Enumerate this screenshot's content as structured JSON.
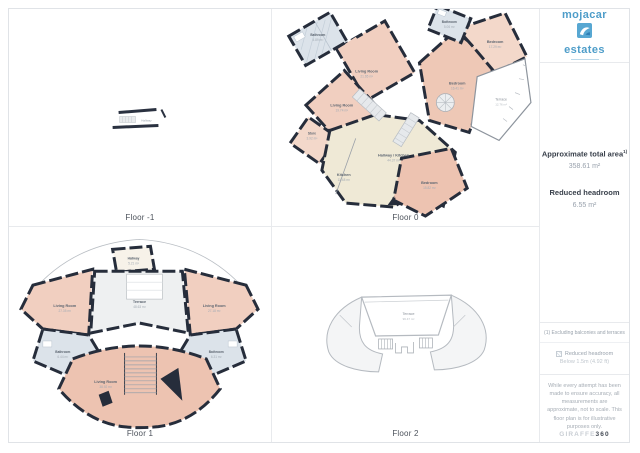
{
  "brand": {
    "word_top": "mojacar",
    "word_bottom": "estates",
    "color": "#4e9dc9"
  },
  "sidebar": {
    "total_area": {
      "label": "Approximate total area",
      "sup": "1)",
      "value": "358.61 m²"
    },
    "headroom": {
      "label": "Reduced headroom",
      "value": "6.55 m²"
    },
    "footnote": "(1) Excluding balconies and terraces",
    "legend": {
      "line1": "Reduced headroom",
      "line2": "Below 1.5m (4.92 ft)"
    },
    "disclaimer": "While every attempt has been made to ensure accuracy, all measurements are approximate, not to scale. This floor plan is for illustrative purposes only.",
    "watermark": {
      "light": "GIRAFFE",
      "bold": "360"
    }
  },
  "floors": [
    {
      "label": "Floor -1",
      "rooms": [
        {
          "name": "Hallway",
          "area": ""
        }
      ]
    },
    {
      "label": "Floor 0",
      "rooms": [
        {
          "name": "Bathroom",
          "area": "4.89 m²"
        },
        {
          "name": "Living Room",
          "area": "21.65 m²"
        },
        {
          "name": "Living Room",
          "area": "19.74 m²"
        },
        {
          "name": "Store",
          "area": "3.92 m²"
        },
        {
          "name": "Kitchen",
          "area": "11.48 m²"
        },
        {
          "name": "Hallway / Kitchen",
          "area": "44.37 m²"
        },
        {
          "name": "Bedroom",
          "area": "15.82 m²"
        },
        {
          "name": "Bathroom",
          "area": "5.06 m²"
        },
        {
          "name": "Bedroom",
          "area": "17.29 m²"
        },
        {
          "name": "Bedroom",
          "area": "16.41 m²"
        },
        {
          "name": "Terrace",
          "area": "12.76 m²"
        }
      ]
    },
    {
      "label": "Floor 1",
      "rooms": [
        {
          "name": "Hallway",
          "area": "5.21 m²"
        },
        {
          "name": "Terrace",
          "area": "48.63 m²"
        },
        {
          "name": "Living Room",
          "area": "27.35 m²"
        },
        {
          "name": "Living Room",
          "area": "27.18 m²"
        },
        {
          "name": "Bathroom",
          "area": "6.44 m²"
        },
        {
          "name": "Bathroom",
          "area": "6.31 m²"
        },
        {
          "name": "Living Room",
          "area": "38.92 m²"
        }
      ]
    },
    {
      "label": "Floor 2",
      "rooms": [
        {
          "name": "Terrace",
          "area": "96.47 m²"
        }
      ]
    }
  ],
  "colors": {
    "wall": "#262d3b",
    "room_peach": "#f1cfc0",
    "room_cream": "#efe9d6",
    "room_blue": "#dce3ea",
    "terrace_gray": "#eef0f1",
    "divider": "#e8eaed",
    "accent": "#4e9dc9"
  }
}
